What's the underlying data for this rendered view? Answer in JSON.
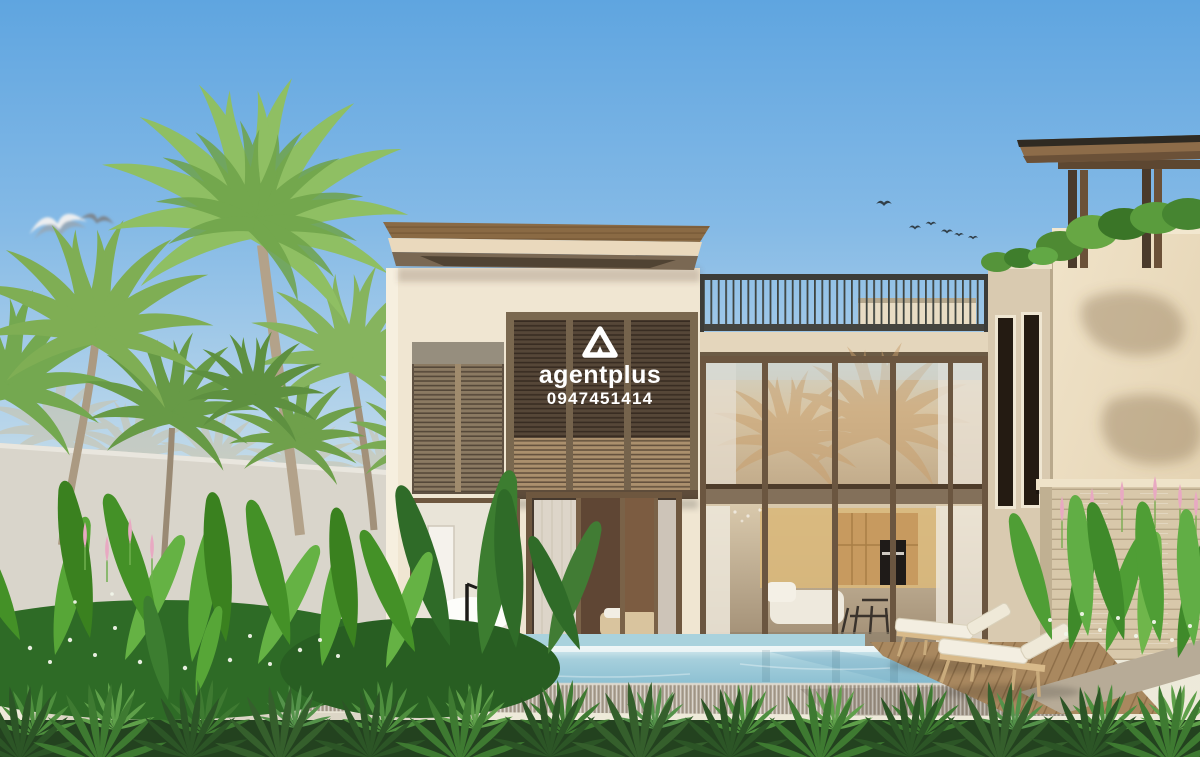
{
  "image": {
    "kind": "3d-architectural-rendering",
    "subject": "Modern two-storey tropical villa with infinity pool, palm garden, glass curtain wall and rooftop pergola"
  },
  "watermark": {
    "logo": "triangle-a-icon",
    "brand": "agentplus",
    "phone": "0947451414",
    "text_color": "#ffffff"
  },
  "palette": {
    "sky_top": "#5fa5e0",
    "sky_horizon": "#efead9",
    "wall_cream": "#f0e6d2",
    "right_wing_cream": "#ecdec2",
    "roof_wood": "#8a6a44",
    "louver_dark_wood": "#564738",
    "louver_light_band": "#b59873",
    "frame_bronze": "#6e573f",
    "railing_metal": "#3f4440",
    "pool_water": "#9ccbd9",
    "pool_far_reflection": "#e2f1f3",
    "infinity_stone": "#b2a899",
    "deck_wood": "#a9885f",
    "lounger_cushion": "#f3eee1",
    "travertine": "#d8c8aa",
    "foliage_bright": "#6fb64b",
    "foliage_dark": "#2f6b28",
    "fern_foreground": "#2c5526"
  },
  "scene": {
    "sky": "clear blue gradient sky",
    "birds": [
      "two soft-focus seagulls upper left",
      "small bird flock above roof terrace"
    ],
    "architecture": [
      "cream rendered walls",
      "timber louvre shutter boxes",
      "bronze framed two-storey glass wall",
      "roof terrace railing",
      "timber rooftop pergola with planting",
      "travertine feature wall"
    ],
    "interior_visible": [
      "freestanding bathtub with black floor tap",
      "bedroom with sheer curtains",
      "kitchen with timber cabinetry and built-in oven",
      "white sofa and dining chairs"
    ],
    "pool_area": [
      "turquoise infinity pool with stone spill edge",
      "timber pool deck",
      "two white sun loungers"
    ],
    "landscape": [
      "coconut palms",
      "heliconia bed with white flowers",
      "pink flower spikes",
      "foreground fern hedge"
    ]
  }
}
